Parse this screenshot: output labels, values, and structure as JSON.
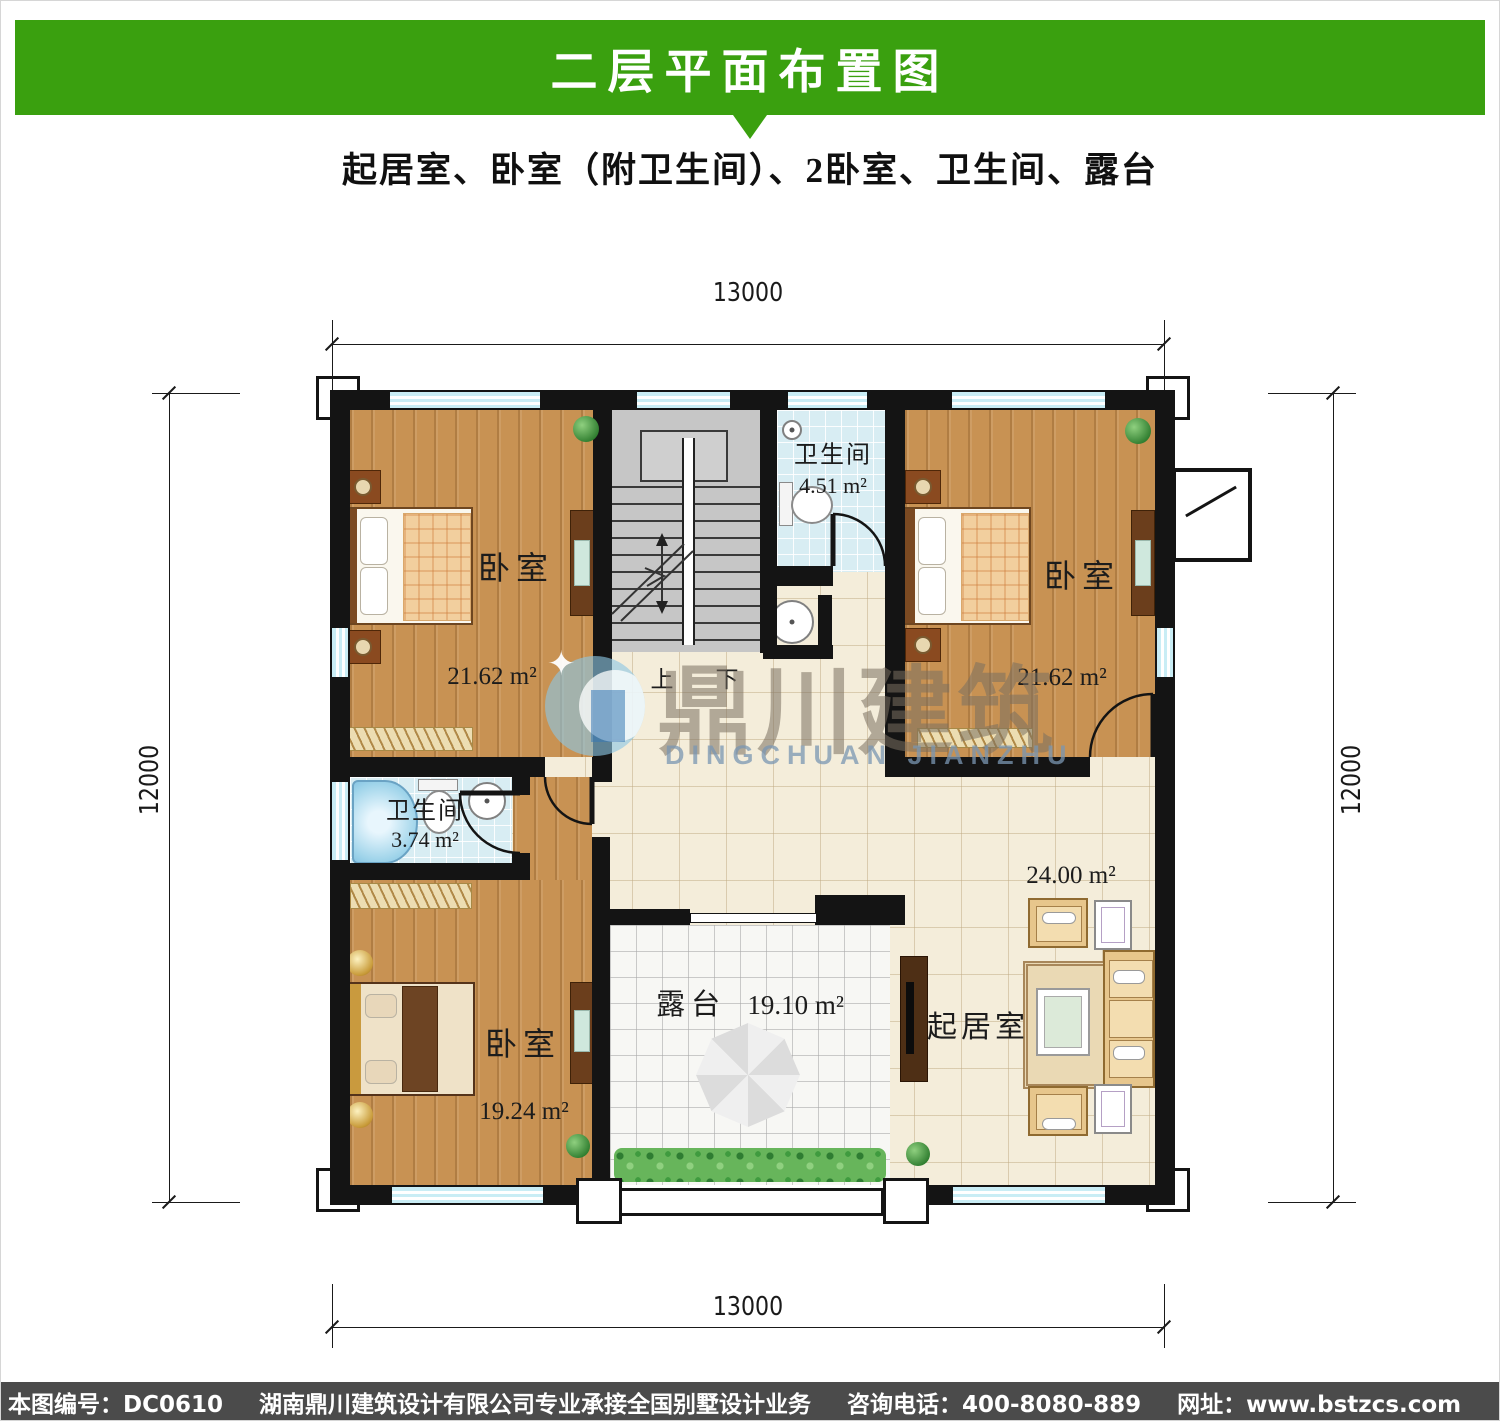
{
  "header": {
    "title": "二层平面布置图",
    "subtitle": "起居室、卧室（附卫生间）、2卧室、卫生间、露台",
    "banner_color": "#3aa00f"
  },
  "plan": {
    "dim_top": "13000",
    "dim_bottom": "13000",
    "dim_left": "12000",
    "dim_right": "12000",
    "rooms": {
      "bedroom_tl": {
        "name": "卧室",
        "area": "21.62 m²"
      },
      "bedroom_tr": {
        "name": "卧室",
        "area": "21.62 m²"
      },
      "bedroom_bl": {
        "name": "卧室",
        "area": "19.24 m²"
      },
      "bath_top": {
        "name": "卫生间",
        "area": "4.51 m²"
      },
      "bath_left": {
        "name": "卫生间",
        "area": "3.74 m²"
      },
      "living": {
        "name": "起居室",
        "area": "24.00 m²"
      },
      "terrace": {
        "name": "露台",
        "area": "19.10 m²"
      }
    },
    "stairs": {
      "up": "上",
      "down": "下"
    }
  },
  "watermark": {
    "cn": "鼎川建筑",
    "en": "DINGCHUAN JIANZHU"
  },
  "footer": {
    "items": [
      "本图编号：DC0610",
      "湖南鼎川建筑设计有限公司专业承接全国别墅设计业务",
      "咨询电话：400-8080-889",
      "网址：www.bstzcs.com"
    ]
  }
}
